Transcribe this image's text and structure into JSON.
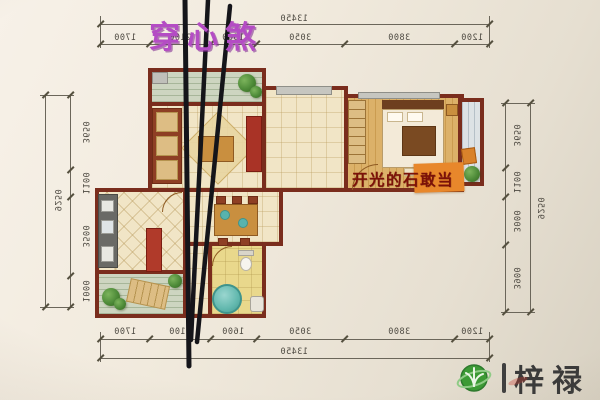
{
  "annotations": {
    "title": "穿心煞",
    "caption": "开光的石敢当",
    "watermark_brand": "梓禄"
  },
  "dimensions": {
    "top": {
      "total": "13450",
      "segments": [
        "1700",
        "2100",
        "1600",
        "3050",
        "3800",
        "1200"
      ]
    },
    "bottom": {
      "total": "13450",
      "segments": [
        "1700",
        "2100",
        "1600",
        "3050",
        "3800",
        "1200"
      ]
    },
    "left": {
      "total": "9250",
      "segments": [
        "3650",
        "1100",
        "3500",
        "1000"
      ]
    },
    "right": {
      "total": "9250",
      "segments": [
        "3650",
        "1100",
        "3000",
        "3900"
      ]
    }
  },
  "colors": {
    "wall": "#7a2d1d",
    "floor_tile": "#f1e5c6",
    "floor_wood": "#dcb169",
    "balcony_green": "#cdd5c0",
    "balcony_blue": "#dde2e5",
    "bathroom_floor": "#e9d88c",
    "sha_line": "#15151a",
    "title_purple": "#b44cc4",
    "caption_red": "#7c1108",
    "caption_highlight": "#e8872b",
    "watermark_green": "#3c9a35",
    "accent_red_furniture": "#a93326",
    "tub_teal": "#62b8ae"
  }
}
